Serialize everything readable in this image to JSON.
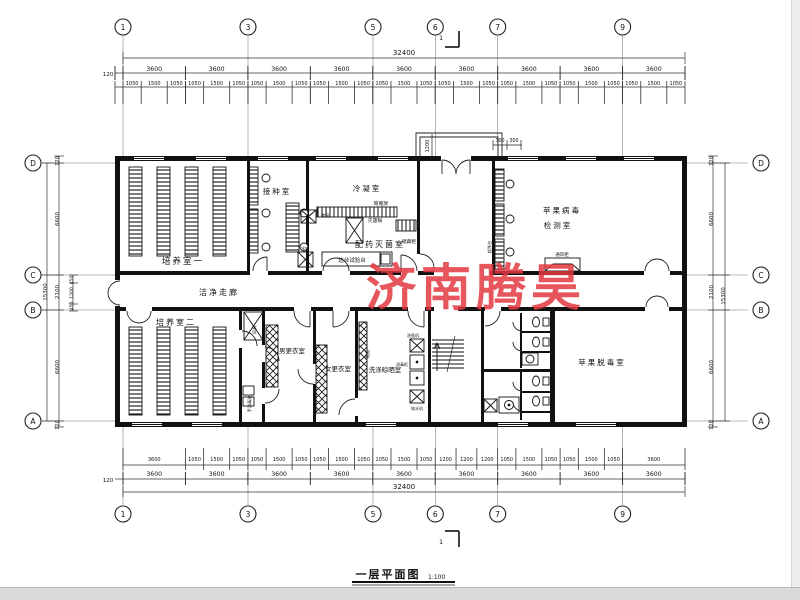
{
  "title": {
    "name": "一层平面图",
    "scale": "1:100"
  },
  "watermark": {
    "text": "济南腾昊",
    "color": "#e23940"
  },
  "grid": {
    "cols": [
      "1",
      "3",
      "5",
      "6",
      "7",
      "9"
    ],
    "rows": [
      "D",
      "C",
      "B",
      "A"
    ]
  },
  "dims": {
    "overall_h": "32400",
    "eave": "120",
    "bays": [
      "3600",
      "3600",
      "3600",
      "3600",
      "3600",
      "3600",
      "3600",
      "3600",
      "3600"
    ],
    "top_sub": [
      "1050",
      "1500",
      "1050",
      "1050",
      "1500",
      "1050",
      "1050",
      "1500",
      "1050",
      "1050",
      "1500",
      "1050",
      "1050",
      "1500",
      "1050",
      "1050",
      "1500",
      "1050",
      "1050",
      "1500",
      "1050",
      "1050",
      "1500",
      "1050",
      "1050",
      "1500",
      "1050"
    ],
    "bottom_sub": [
      "3600",
      "1050",
      "1500",
      "1050",
      "1050",
      "1500",
      "1050",
      "1050",
      "1500",
      "1050",
      "1050",
      "1500",
      "1050",
      "1200",
      "1200",
      "1200",
      "1050",
      "1500",
      "1050",
      "1050",
      "1500",
      "1050",
      "3600"
    ],
    "overall_v": "15300",
    "left_segments": [
      "120",
      "6600",
      "2100",
      "6600",
      "120"
    ],
    "left_sub": [
      "450",
      "1200",
      "450"
    ],
    "right_segments": [
      "120",
      "6600",
      "2100",
      "6600",
      "120"
    ],
    "entrance": {
      "depth": "1200",
      "left": "300",
      "right": "300"
    },
    "section": "1"
  },
  "rooms": {
    "peiyang1": "培养室一",
    "jiezhong": "接种室",
    "lengning": "冷凝室",
    "peiyao": "配药灭菌室",
    "bingdu_l1": "苹果病毒",
    "bingdu_l2": "检测室",
    "zoulang": "洁净走廊",
    "peiyang2": "培养室二",
    "nangeng": "男更衣室",
    "nugeng": "女更衣室",
    "xidi": "洗涤晾晒室",
    "tuodu": "苹果脱毒室"
  },
  "eq": {
    "liang": "晾瓶架",
    "mie": "灭菌锅",
    "chu": "储藏柜",
    "bian": "边台试验台",
    "di": "递窗",
    "bing": "冰箱",
    "chao": "超净台",
    "tong": "通风柜",
    "feng": "风淋",
    "shou": "手消毒池",
    "xie": "鞋柜",
    "xiping": "洗瓶机",
    "xiao": "消毒柜",
    "chun": "纯水机"
  }
}
